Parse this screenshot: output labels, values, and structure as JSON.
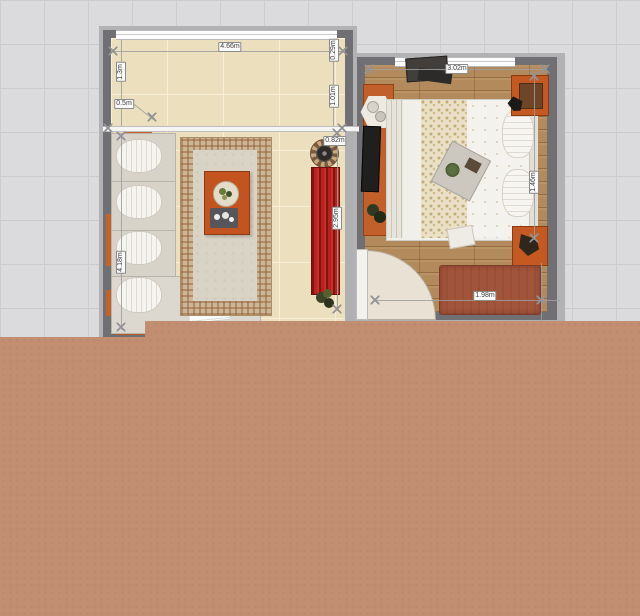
{
  "canvas": {
    "description": "2D floor plan top view with two furnished rooms on a grid",
    "grid_bg": "#dbdbde",
    "terrain_color": "#c28e72",
    "wall_color": "#707074",
    "tile_floor_color": "#ebdfbd",
    "wood_floor_color": "#b28a5b",
    "accent_red": "#b8211d",
    "accent_orange": "#c45a22"
  },
  "dims": {
    "lr_top": "4.66m",
    "lr_left_upper": "1.3m",
    "lr_offset": "0.5m",
    "lr_right_upper": "0.29m",
    "lr_right_lower": "1.01m",
    "lr_inner_width": "0.82m",
    "lr_cabinet_length": "2.95m",
    "lr_left_height": "4.18m",
    "br_top": "3.02m",
    "br_right": "1.46m",
    "br_bottom": "1.98m"
  },
  "rooms": [
    {
      "name": "living-room",
      "floor": "beige-tile"
    },
    {
      "name": "bedroom",
      "floor": "wood-plank"
    }
  ],
  "objects": [
    "sectional-sofa",
    "throw-pillows",
    "chaise-paper",
    "area-rug",
    "coffee-table",
    "fruit-plate",
    "serving-tray",
    "round-fan-table",
    "red-tv-cabinet",
    "potted-plant",
    "runner-rug",
    "hexagonal-side-table",
    "tv-console",
    "dresser",
    "double-bed",
    "bed-pillows",
    "bed-tray",
    "nightstand",
    "foot-bench",
    "door-leaf",
    "door-swing"
  ]
}
